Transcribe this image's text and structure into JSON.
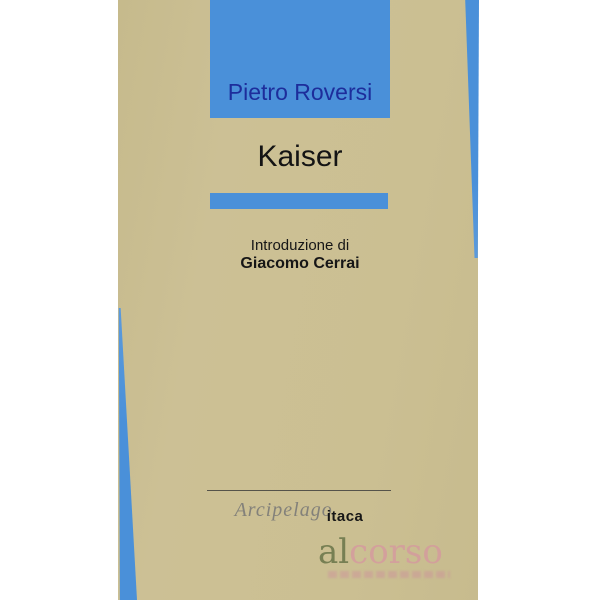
{
  "cover": {
    "author": "Pietro Roversi",
    "title": "Kaiser",
    "intro_label": "Introduzione di",
    "intro_author": "Giacomo Cerrai"
  },
  "publisher": {
    "script_name": "Arcipelago",
    "suffix_name": "itaca"
  },
  "watermark": {
    "part_al": "al",
    "part_corso": "corso"
  },
  "colors": {
    "cover_tan": "#cbbf92",
    "accent_blue": "#4a90d9",
    "author_text_blue": "#1d2d9b",
    "title_black": "#141414",
    "publisher_gray": "#83817a",
    "watermark_olive": "#647046",
    "watermark_pink": "#d88ca3"
  }
}
